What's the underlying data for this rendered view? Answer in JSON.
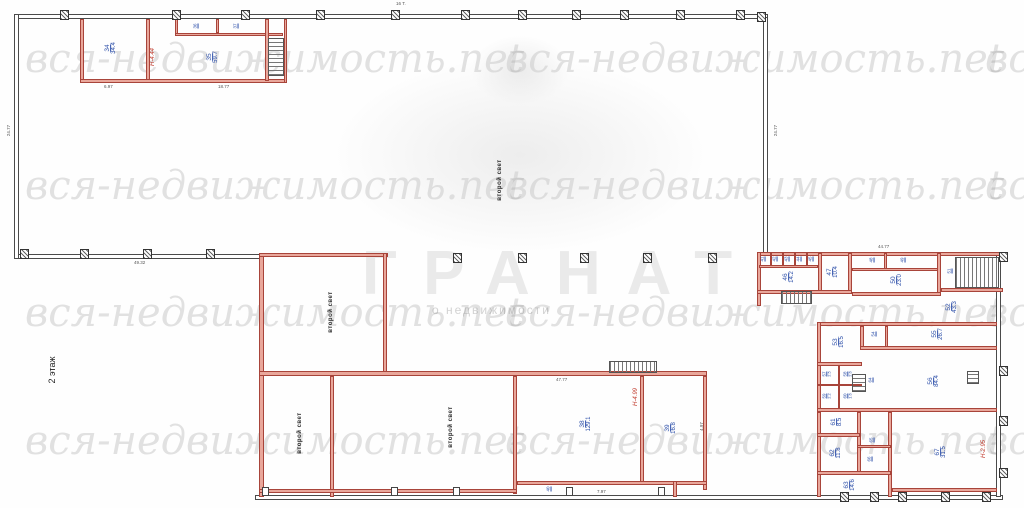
{
  "title": {
    "floor_label": "2 этаж"
  },
  "watermark": {
    "tile_text": "вся-недвижимость.net",
    "rows_y": [
      36,
      163,
      290,
      418
    ],
    "cols_x": [
      25,
      505,
      985
    ],
    "logo_text": "ГРАНАТ",
    "logo_subtext": "о недвижимости"
  },
  "open_space": {
    "label": "второй свет",
    "positions": [
      {
        "x": 500,
        "y": 180
      },
      {
        "x": 331,
        "y": 312
      },
      {
        "x": 300,
        "y": 433
      },
      {
        "x": 451,
        "y": 427
      }
    ]
  },
  "rooms": [
    {
      "n": "34",
      "a": "34.4",
      "x": 111,
      "y": 48,
      "s": 0
    },
    {
      "n": "35",
      "a": "59.7",
      "x": 213,
      "y": 57,
      "s": 0
    },
    {
      "n": "36",
      "a": "",
      "x": 196,
      "y": 26,
      "s": 1
    },
    {
      "n": "37",
      "a": "",
      "x": 236,
      "y": 26,
      "s": 1
    },
    {
      "n": "38",
      "a": "129.1",
      "x": 586,
      "y": 424,
      "s": 0
    },
    {
      "n": "39",
      "a": "16.8",
      "x": 671,
      "y": 428,
      "s": 0
    },
    {
      "n": "40",
      "a": "",
      "x": 549,
      "y": 489,
      "s": 1
    },
    {
      "n": "41",
      "a": "",
      "x": 763,
      "y": 259,
      "s": 1
    },
    {
      "n": "42",
      "a": "",
      "x": 775,
      "y": 259,
      "s": 1
    },
    {
      "n": "43",
      "a": "",
      "x": 787,
      "y": 259,
      "s": 1
    },
    {
      "n": "44",
      "a": "",
      "x": 799,
      "y": 259,
      "s": 1
    },
    {
      "n": "45",
      "a": "",
      "x": 811,
      "y": 259,
      "s": 1
    },
    {
      "n": "46",
      "a": "14.2",
      "x": 789,
      "y": 277,
      "s": 0
    },
    {
      "n": "47",
      "a": "10.4",
      "x": 833,
      "y": 272,
      "s": 0
    },
    {
      "n": "48",
      "a": "",
      "x": 872,
      "y": 260,
      "s": 1
    },
    {
      "n": "49",
      "a": "",
      "x": 903,
      "y": 260,
      "s": 1
    },
    {
      "n": "50",
      "a": "23.0",
      "x": 897,
      "y": 280,
      "s": 0
    },
    {
      "n": "51",
      "a": "",
      "x": 950,
      "y": 271,
      "s": 1
    },
    {
      "n": "52",
      "a": "43.3",
      "x": 952,
      "y": 307,
      "s": 0
    },
    {
      "n": "53",
      "a": "16.5",
      "x": 839,
      "y": 342,
      "s": 0
    },
    {
      "n": "54",
      "a": "",
      "x": 874,
      "y": 334,
      "s": 1
    },
    {
      "n": "55",
      "a": "26.7",
      "x": 938,
      "y": 334,
      "s": 0
    },
    {
      "n": "56",
      "a": "84.4",
      "x": 934,
      "y": 381,
      "s": 0
    },
    {
      "n": "57",
      "a": "2.5",
      "x": 827,
      "y": 374,
      "s": 1
    },
    {
      "n": "58",
      "a": "2.6",
      "x": 848,
      "y": 374,
      "s": 1
    },
    {
      "n": "59",
      "a": "2.2",
      "x": 827,
      "y": 396,
      "s": 1
    },
    {
      "n": "60",
      "a": "1.6",
      "x": 848,
      "y": 396,
      "s": 1
    },
    {
      "n": "61",
      "a": "8.5",
      "x": 837,
      "y": 422,
      "s": 0
    },
    {
      "n": "62",
      "a": "11.8",
      "x": 836,
      "y": 453,
      "s": 0
    },
    {
      "n": "63",
      "a": "14.6",
      "x": 850,
      "y": 485,
      "s": 0
    },
    {
      "n": "64",
      "a": "",
      "x": 871,
      "y": 380,
      "s": 1
    },
    {
      "n": "65",
      "a": "",
      "x": 872,
      "y": 440,
      "s": 1
    },
    {
      "n": "66",
      "a": "",
      "x": 870,
      "y": 459,
      "s": 1
    },
    {
      "n": "67",
      "a": "31.5",
      "x": 941,
      "y": 452,
      "s": 0
    }
  ],
  "height_labels": [
    {
      "text": "Н-4.44",
      "x": 153,
      "y": 57
    },
    {
      "text": "Н-4.99",
      "x": 636,
      "y": 397
    },
    {
      "text": "Н-2.95",
      "x": 984,
      "y": 449
    }
  ],
  "dimensions": [
    {
      "t": "16 Т.",
      "x": 396,
      "y": 1,
      "r": 0
    },
    {
      "t": "24.77",
      "x": 3,
      "y": 128,
      "r": -90
    },
    {
      "t": "24.77",
      "x": 770,
      "y": 128,
      "r": -90
    },
    {
      "t": "49.32",
      "x": 134,
      "y": 260,
      "r": 0
    },
    {
      "t": "44.77",
      "x": 878,
      "y": 244,
      "r": 0
    },
    {
      "t": "6.97",
      "x": 104,
      "y": 84,
      "r": 0
    },
    {
      "t": "18.77",
      "x": 218,
      "y": 84,
      "r": 0
    },
    {
      "t": "47.77",
      "x": 556,
      "y": 377,
      "r": 0
    },
    {
      "t": "4.97",
      "x": 697,
      "y": 424,
      "r": -90
    },
    {
      "t": "7.97",
      "x": 597,
      "y": 489,
      "r": 0
    }
  ],
  "colors": {
    "wall_red": "#a8443a",
    "wall_red_fill": "#e9a79b",
    "wall_dark": "#4a4a4a",
    "room_label_blue": "#2a4da8",
    "height_label_red": "#c0392b",
    "watermark_gray": "#6e6e6e"
  }
}
